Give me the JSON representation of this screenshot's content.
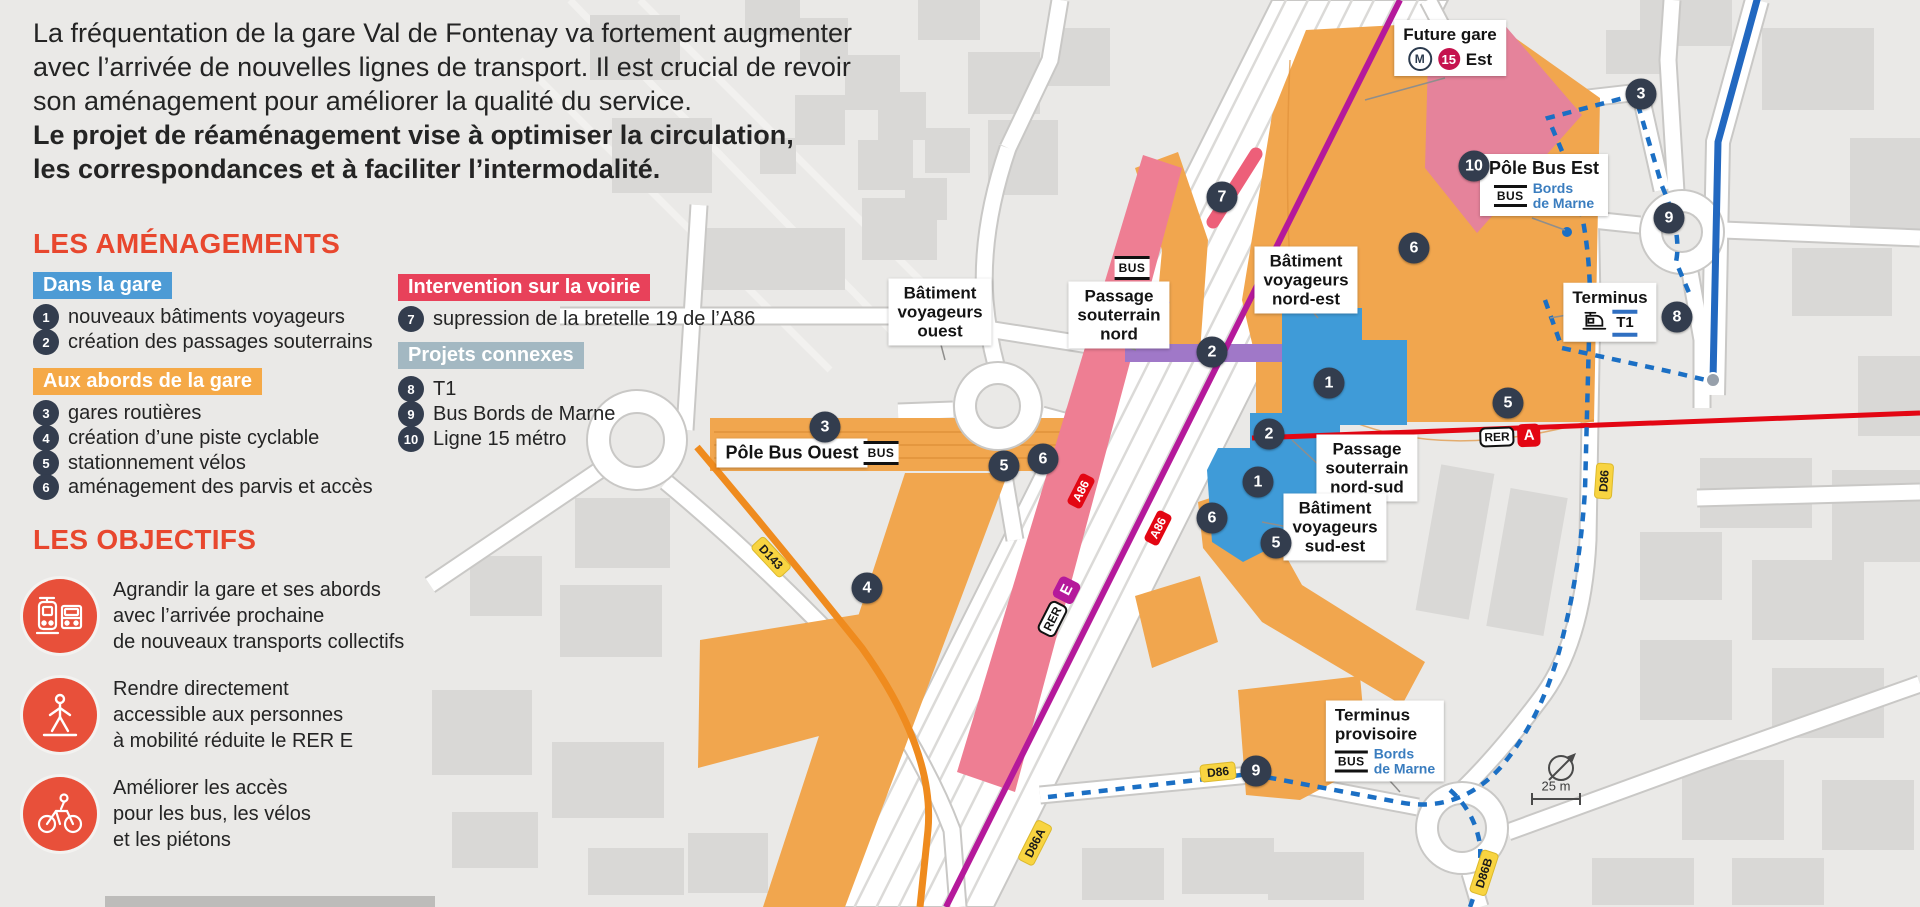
{
  "intro": {
    "lines": [
      "La fréquentation de la gare Val de Fontenay va fortement augmenter",
      "avec l’arrivée de nouvelles lignes de transport. Il est crucial de revoir",
      "son aménagement pour améliorer la qualité du service."
    ],
    "bold_lines": [
      "Le projet de réaménagement vise à optimiser la circulation,",
      "les correspondances et à faciliter l’intermodalité."
    ]
  },
  "legend": {
    "amenagements_title": "LES AMÉNAGEMENTS",
    "dans_la_gare": {
      "badge": "Dans la gare",
      "items": [
        {
          "num": "1",
          "label": "nouveaux bâtiments voyageurs"
        },
        {
          "num": "2",
          "label": "création des passages souterrains"
        }
      ]
    },
    "aux_abords": {
      "badge": "Aux abords de la gare",
      "items": [
        {
          "num": "3",
          "label": "gares routières"
        },
        {
          "num": "4",
          "label": "création d’une piste cyclable"
        },
        {
          "num": "5",
          "label": "stationnement vélos"
        },
        {
          "num": "6",
          "label": "aménagement des parvis et accès"
        }
      ]
    },
    "voirie": {
      "badge": "Intervention sur la voirie",
      "items": [
        {
          "num": "7",
          "label": "supression de la bretelle 19 de l’A86"
        }
      ]
    },
    "connexes": {
      "badge": "Projets connexes",
      "items": [
        {
          "num": "8",
          "label": "T1"
        },
        {
          "num": "9",
          "label": "Bus Bords de Marne"
        },
        {
          "num": "10",
          "label": "Ligne 15 métro"
        }
      ]
    },
    "objectifs_title": "LES OBJECTIFS",
    "objectifs": [
      {
        "icon": "tram-bus",
        "lines": [
          "Agrandir la gare et ses abords",
          "avec l’arrivée prochaine",
          "de nouveaux transports collectifs"
        ]
      },
      {
        "icon": "pedestrian",
        "lines": [
          "Rendre directement",
          "accessible aux personnes",
          "à mobilité réduite le RER E"
        ]
      },
      {
        "icon": "cyclist",
        "lines": [
          "Améliorer les accès",
          "pour les bus, les vélos",
          "et les piétons"
        ]
      }
    ]
  },
  "map": {
    "labels": {
      "batiment_ouest": {
        "l1": "Bâtiment",
        "l2": "voyageurs",
        "l3": "ouest"
      },
      "passage_nord": {
        "l1": "Passage",
        "l2": "souterrain",
        "l3": "nord"
      },
      "pole_bus_ouest": {
        "title": "Pôle Bus Ouest"
      },
      "batiment_nord_est": {
        "l1": "Bâtiment",
        "l2": "voyageurs",
        "l3": "nord-est"
      },
      "passage_nord_sud": {
        "l1": "Passage",
        "l2": "souterrain",
        "l3": "nord-sud"
      },
      "batiment_sud_est": {
        "l1": "Bâtiment",
        "l2": "voyageurs",
        "l3": "sud-est"
      },
      "future_gare": {
        "l1": "Future gare",
        "metro": "M",
        "line_number": "15",
        "l2": "Est"
      },
      "pole_bus_est": {
        "title": "Pôle Bus Est",
        "dest1": "Bords",
        "dest2": "de Marne"
      },
      "terminus_t1": {
        "title": "Terminus",
        "t1": "T1"
      },
      "terminus_provisoire": {
        "l1": "Terminus",
        "l2": "provisoire",
        "dest1": "Bords",
        "dest2": "de Marne"
      }
    },
    "bus_badge": "BUS",
    "rer_a": {
      "rer": "RER",
      "letter": "A"
    },
    "rer_e": {
      "rer": "RER",
      "letter": "E"
    },
    "road_badges": {
      "a86_west": "A86",
      "a86_east": "A86",
      "d143": "D143",
      "d86a": "D86A",
      "d86_south": "D86",
      "d86_east": "D86",
      "d86b": "D86B"
    },
    "numbered": [
      "7",
      "2",
      "3",
      "6",
      "5",
      "4",
      "10",
      "3",
      "9",
      "6",
      "8",
      "5",
      "1",
      "2",
      "1",
      "6",
      "5",
      "9"
    ],
    "scale_label": "25 m"
  },
  "colors": {
    "accent": "#e8472e",
    "dans_la_gare_badge": "#4d9bd5",
    "aux_abords_badge": "#f5a947",
    "voirie_badge": "#e8415a",
    "connexes_badge": "#a3b8c2",
    "numbered_badge": "#333d4e",
    "map_orange": "#f1a64e",
    "map_pink": "#ec7d92",
    "map_blue": "#3f9bd8",
    "map_purple": "#a078c8",
    "metro15_magenta": "#b5199b",
    "rer_a_red": "#e30613",
    "t1_blue": "#2268c0",
    "bus_route_blue": "#1b6fc4",
    "cycle_orange": "#ef8b1e",
    "bords_de_marne_text": "#3a7dbf",
    "objective_icon": "#e8503a",
    "road_badge_yellow": "#f8d441"
  }
}
